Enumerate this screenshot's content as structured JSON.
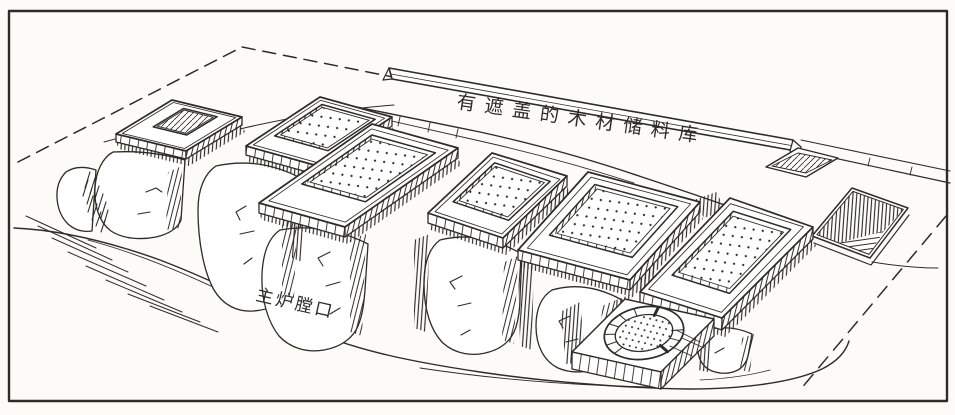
{
  "figure": {
    "kind": "archaeological-perspective-line-drawing",
    "ink_color": "#2f2b26",
    "paper_color": "#fcfbf7",
    "depicts": "Terraced row of six rectangular kiln platforms with perforated floors on eroded earthen mounds, a long covered timber storage shed behind them, a round furnace, a sunken pit and dashed excavation boundary lines inside a rectangular frame."
  },
  "labels": {
    "shed": {
      "text": "有遮盖的木材储料库"
    },
    "furnace_mouth": {
      "text": "主炉膛口"
    }
  }
}
